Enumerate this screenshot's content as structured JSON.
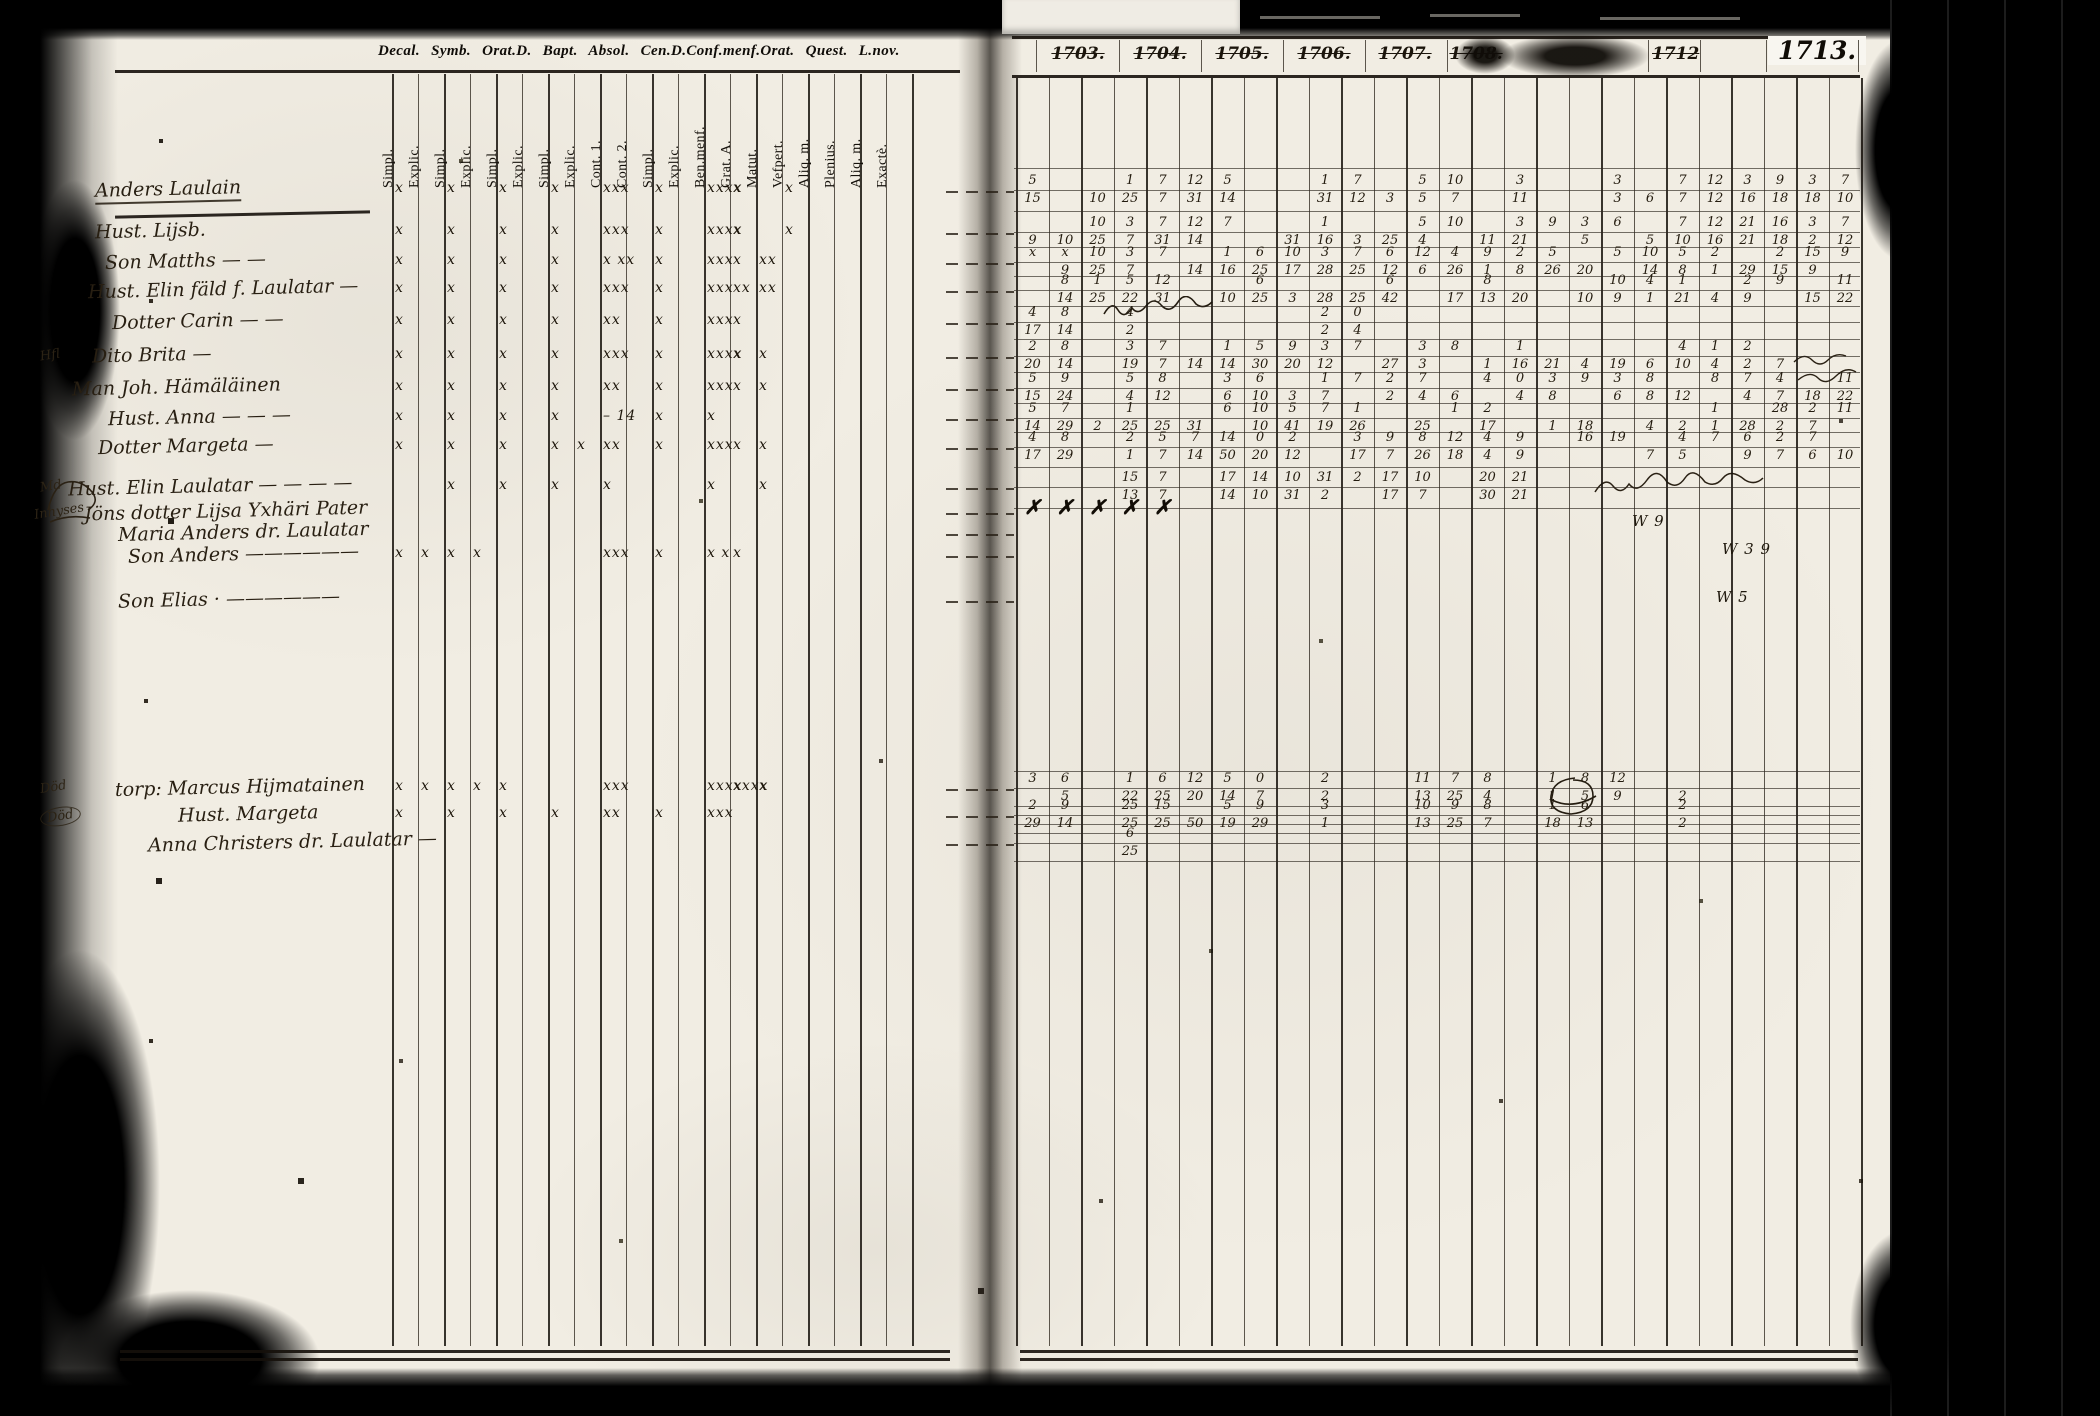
{
  "printed_header": "Decal. Symb. Orat.D. Bapt. Absol. Cen.D.Conf.menf.Orat. Quest. L.nov.",
  "left_page": {
    "column_labels": [
      "Simpl.",
      "Explic.",
      "Simpl.",
      "Explic.",
      "Simpl.",
      "Explic.",
      "Simpl.",
      "Explic.",
      "Cont. 1.",
      "Cont. 2.",
      "Simpl.",
      "Explic.",
      "Ben.menf.",
      "Grat. A.",
      "Matut.",
      "Vefpert.",
      "Aliq. m.",
      "Plenius.",
      "Aliq. m.",
      "Exactè."
    ],
    "rows": [
      {
        "margin": "",
        "name": "Anders Laulain",
        "marks": [
          "x",
          "",
          "x",
          "",
          "x",
          "",
          "x",
          "",
          "xxx",
          "",
          "x",
          "",
          "xxxx",
          "x",
          "",
          "x",
          "",
          "",
          "",
          ""
        ]
      },
      {
        "margin": "",
        "name": "Hust. Lijsb.",
        "marks": [
          "x",
          "",
          "x",
          "",
          "x",
          "",
          "x",
          "",
          "xxx",
          "",
          "x",
          "",
          "xxxx",
          "x",
          "",
          "x",
          "",
          "",
          "",
          ""
        ]
      },
      {
        "margin": "",
        "name": "Son Matths — —",
        "marks": [
          "x",
          "",
          "x",
          "",
          "x",
          "",
          "x",
          "",
          "x xx",
          "",
          "x",
          "",
          "xxx",
          "x",
          "xx",
          "",
          "",
          "",
          "",
          ""
        ]
      },
      {
        "margin": "",
        "name": "Hust. Elin fäld f. Laulatar —",
        "marks": [
          "x",
          "",
          "x",
          "",
          "x",
          "",
          "x",
          "",
          "xxx",
          "",
          "x",
          "",
          "xxx",
          "xx",
          "xx",
          "",
          "",
          "",
          "",
          ""
        ]
      },
      {
        "margin": "",
        "name": "Dotter Carin — —",
        "marks": [
          "x",
          "",
          "x",
          "",
          "x",
          "",
          "x",
          "",
          "xx",
          "",
          "x",
          "",
          "xxx",
          "x",
          "",
          "",
          "",
          "",
          "",
          ""
        ]
      },
      {
        "margin": "Hfl",
        "name": "Dito Brita —",
        "marks": [
          "x",
          "",
          "x",
          "",
          "x",
          "",
          "x",
          "",
          "xxx",
          "",
          "x",
          "",
          "xxxx",
          "x",
          "x",
          "",
          "",
          "",
          "",
          ""
        ]
      },
      {
        "margin": "",
        "name": "Man Joh. Hämäläinen",
        "marks": [
          "x",
          "",
          "x",
          "",
          "x",
          "",
          "x",
          "",
          "xx",
          "",
          "x",
          "",
          "xxx",
          "x",
          "x",
          "",
          "",
          "",
          "",
          ""
        ]
      },
      {
        "margin": "",
        "name": "Hust. Anna — — —",
        "marks": [
          "x",
          "",
          "x",
          "",
          "x",
          "",
          "x",
          "",
          "– 14",
          "",
          "x",
          "",
          "x",
          "",
          "",
          "",
          "",
          "",
          "",
          ""
        ]
      },
      {
        "margin": "",
        "name": "Dotter Margeta —",
        "marks": [
          "x",
          "",
          "x",
          "",
          "x",
          "",
          "x",
          "x",
          "xx",
          "",
          "x",
          "",
          "xxx",
          "x",
          "x",
          "",
          "",
          "",
          "",
          ""
        ]
      },
      {
        "margin": "Md",
        "name": "Hust. Elin Laulatar — — — —",
        "marks": [
          "",
          "",
          "x",
          "",
          "x",
          "",
          "x",
          "",
          "x",
          "",
          "",
          "",
          "x",
          "",
          "x",
          "",
          "",
          "",
          "",
          ""
        ]
      },
      {
        "margin": "Inhyses",
        "name": "Jöns dotter Lijsa Yxhäri Pater",
        "marks": [
          "",
          "",
          "",
          "",
          "",
          "",
          "",
          "",
          "",
          "",
          "",
          "",
          "",
          "",
          "",
          "",
          "",
          "",
          "",
          ""
        ]
      },
      {
        "margin": "",
        "name": "Maria Anders dr. Laulatar",
        "marks": [
          "",
          "",
          "",
          "",
          "",
          "",
          "",
          "",
          "",
          "",
          "",
          "",
          "",
          "",
          "",
          "",
          "",
          "",
          "",
          ""
        ]
      },
      {
        "margin": "",
        "name": "Son Anders ——————",
        "marks": [
          "x",
          "x",
          "x",
          "x",
          "",
          "",
          "",
          "",
          "xxx",
          "",
          "x",
          "",
          "x x",
          "x",
          "",
          "",
          "",
          "",
          "",
          ""
        ]
      },
      {
        "margin": "",
        "name": "Son Elias · ——————",
        "marks": [
          "",
          "",
          "",
          "",
          "",
          "",
          "",
          "",
          "",
          "",
          "",
          "",
          "",
          "",
          "",
          "",
          "",
          "",
          "",
          ""
        ]
      },
      {
        "margin": "Död",
        "name": "torp: Marcus Hijmatainen",
        "marks": [
          "x",
          "x",
          "x",
          "x",
          "x",
          "",
          "",
          "",
          "xxx",
          "",
          "",
          "",
          "xxxx",
          "xxxx",
          "x",
          "",
          "",
          "",
          "",
          ""
        ]
      },
      {
        "margin": "Död",
        "name": "Hust. Margeta",
        "marks": [
          "x",
          "",
          "x",
          "",
          "x",
          "",
          "x",
          "",
          "xx",
          "",
          "x",
          "",
          "xxx",
          "",
          "",
          "",
          "",
          "",
          "",
          ""
        ]
      },
      {
        "margin": "",
        "name": "Anna Christers dr. Laulatar —",
        "marks": [
          "",
          "",
          "",
          "",
          "",
          "",
          "",
          "",
          "",
          "",
          "",
          "",
          "",
          "",
          "",
          "",
          "",
          "",
          "",
          ""
        ]
      }
    ]
  },
  "right_page": {
    "years": [
      {
        "label": "1703.",
        "struck": true
      },
      {
        "label": "1704.",
        "struck": true
      },
      {
        "label": "1705.",
        "struck": true
      },
      {
        "label": "1706.",
        "struck": true
      },
      {
        "label": "1707.",
        "struck": true
      },
      {
        "label": "1708.",
        "struck": true
      },
      {
        "label": "1712",
        "struck": true
      },
      {
        "label": "1713.",
        "struck": false
      }
    ],
    "rows": [
      {
        "l1": [
          "5",
          "",
          "",
          "1",
          "7",
          "12",
          "5",
          "",
          "",
          "1",
          "7",
          "",
          "5",
          "10",
          "",
          "3",
          "",
          "",
          "3",
          "",
          "7",
          "12",
          "3",
          "9",
          "3",
          "7"
        ],
        "l2": [
          "15",
          "",
          "10",
          "25",
          "7",
          "31",
          "14",
          "",
          "",
          "31",
          "12",
          "3",
          "5",
          "7",
          "",
          "11",
          "",
          "",
          "3",
          "6",
          "7",
          "12",
          "16",
          "18",
          "18",
          "10"
        ]
      },
      {
        "l1": [
          "",
          "",
          "10",
          "3",
          "7",
          "12",
          "7",
          "",
          "",
          "1",
          "",
          "",
          "5",
          "10",
          "",
          "3",
          "9",
          "3",
          "6",
          "",
          "7",
          "12",
          "21",
          "16",
          "3",
          "7"
        ],
        "l2": [
          "9",
          "10",
          "25",
          "7",
          "31",
          "14",
          "",
          "",
          "31",
          "16",
          "3",
          "25",
          "4",
          "",
          "11",
          "21",
          "",
          "5",
          "",
          "5",
          "10",
          "16",
          "21",
          "18",
          "2",
          "12"
        ]
      },
      {
        "l1": [
          "x",
          "x",
          "10",
          "3",
          "7",
          "",
          "1",
          "6",
          "10",
          "3",
          "7",
          "6",
          "12",
          "4",
          "9",
          "2",
          "5",
          "",
          "5",
          "10",
          "5",
          "2",
          "",
          "2",
          "15",
          "9"
        ],
        "l2": [
          "",
          "9",
          "25",
          "7",
          "",
          "14",
          "16",
          "25",
          "17",
          "28",
          "25",
          "12",
          "6",
          "26",
          "1",
          "8",
          "26",
          "20",
          "",
          "14",
          "8",
          "1",
          "29",
          "15",
          "9",
          ""
        ]
      },
      {
        "l1": [
          "",
          "8",
          "1",
          "5",
          "12",
          "",
          "",
          "6",
          "",
          "",
          "",
          "6",
          "",
          "",
          "8",
          "",
          "",
          "",
          "10",
          "4",
          "1",
          "",
          "2",
          "9",
          "",
          "11"
        ],
        "l2": [
          "",
          "14",
          "25",
          "22",
          "31",
          "",
          "10",
          "25",
          "3",
          "28",
          "25",
          "42",
          "",
          "17",
          "13",
          "20",
          "",
          "10",
          "9",
          "1",
          "21",
          "4",
          "9",
          "",
          "15",
          "22"
        ]
      },
      {
        "l1": [
          "4",
          "8",
          "",
          "4",
          "",
          "",
          "",
          "",
          "",
          "2",
          "0",
          "",
          "",
          "",
          "",
          "",
          "",
          "",
          "",
          "",
          "",
          "",
          "",
          "",
          "",
          ""
        ],
        "l2": [
          "17",
          "14",
          "",
          "2",
          "",
          "",
          "",
          "",
          "",
          "2",
          "4",
          "",
          "",
          "",
          "",
          "",
          "",
          "",
          "",
          "",
          "",
          "",
          "",
          "",
          "",
          ""
        ]
      },
      {
        "l1": [
          "2",
          "8",
          "",
          "3",
          "7",
          "",
          "1",
          "5",
          "9",
          "3",
          "7",
          "",
          "3",
          "8",
          "",
          "1",
          "",
          "",
          "",
          "",
          "4",
          "1",
          "2",
          "",
          "",
          ""
        ],
        "l2": [
          "20",
          "14",
          "",
          "19",
          "7",
          "14",
          "14",
          "30",
          "20",
          "12",
          "",
          "27",
          "3",
          "",
          "1",
          "16",
          "21",
          "4",
          "19",
          "6",
          "10",
          "4",
          "2",
          "7",
          "",
          ""
        ]
      },
      {
        "l1": [
          "5",
          "9",
          "",
          "5",
          "8",
          "",
          "3",
          "6",
          "",
          "1",
          "7",
          "2",
          "7",
          "",
          "4",
          "0",
          "3",
          "9",
          "3",
          "8",
          "",
          "8",
          "7",
          "4",
          "",
          "11"
        ],
        "l2": [
          "15",
          "24",
          "",
          "4",
          "12",
          "",
          "6",
          "10",
          "3",
          "7",
          "",
          "2",
          "4",
          "6",
          "",
          "4",
          "8",
          "",
          "6",
          "8",
          "12",
          "",
          "4",
          "7",
          "18",
          "22"
        ]
      },
      {
        "l1": [
          "5",
          "7",
          "",
          "1",
          "",
          "",
          "6",
          "10",
          "5",
          "7",
          "1",
          "",
          "",
          "1",
          "2",
          "",
          "",
          "",
          "",
          "",
          "",
          "1",
          "",
          "28",
          "2",
          "11"
        ],
        "l2": [
          "14",
          "29",
          "2",
          "25",
          "25",
          "31",
          "",
          "10",
          "41",
          "19",
          "26",
          "",
          "25",
          "",
          "17",
          "",
          "1",
          "18",
          "",
          "4",
          "2",
          "1",
          "28",
          "2",
          "7",
          ""
        ]
      },
      {
        "l1": [
          "4",
          "8",
          "",
          "2",
          "5",
          "7",
          "14",
          "0",
          "2",
          "",
          "3",
          "9",
          "8",
          "12",
          "4",
          "9",
          "",
          "16",
          "19",
          "",
          "4",
          "7",
          "6",
          "2",
          "7",
          ""
        ],
        "l2": [
          "17",
          "29",
          "",
          "1",
          "7",
          "14",
          "50",
          "20",
          "12",
          "",
          "17",
          "7",
          "26",
          "18",
          "4",
          "9",
          "",
          "",
          "",
          "7",
          "5",
          "",
          "9",
          "7",
          "6",
          "10"
        ]
      },
      {
        "l1": [
          "",
          "",
          "",
          "15",
          "7",
          "",
          "17",
          "14",
          "10",
          "31",
          "2",
          "17",
          "10",
          "",
          "20",
          "21",
          "",
          "",
          "",
          "",
          "",
          "",
          "",
          "",
          "",
          ""
        ],
        "l2": [
          "",
          "",
          "",
          "13",
          "7",
          "",
          "14",
          "10",
          "31",
          "2",
          "",
          "17",
          "7",
          "",
          "30",
          "21",
          "",
          "",
          "",
          "",
          "",
          "",
          "",
          "",
          "",
          ""
        ]
      },
      {
        "l1": [
          "✗",
          "✗",
          "✗",
          "✗",
          "✗",
          "",
          "",
          "",
          "",
          "",
          "",
          "",
          "",
          "",
          "",
          "",
          "",
          "",
          "",
          "",
          "",
          "",
          "",
          "",
          "",
          ""
        ],
        "l2": []
      },
      {
        "l1": [],
        "l2": []
      },
      {
        "l1": [],
        "l2": []
      },
      {
        "l1": [],
        "l2": []
      },
      {
        "l1": [
          "3",
          "6",
          "",
          "1",
          "6",
          "12",
          "5",
          "0",
          "",
          "2",
          "",
          "",
          "11",
          "7",
          "8",
          "",
          "1",
          "8",
          "12",
          "",
          "",
          "",
          "",
          "",
          "",
          ""
        ],
        "l2": [
          "",
          "5",
          "",
          "22",
          "25",
          "20",
          "14",
          "7",
          "",
          "2",
          "",
          "",
          "13",
          "25",
          "4",
          "",
          "1",
          "5",
          "9",
          "",
          "2",
          "",
          "",
          "",
          "",
          ""
        ]
      },
      {
        "l1": [
          "2",
          "9",
          "",
          "25",
          "15",
          "",
          "5",
          "9",
          "",
          "3",
          "",
          "",
          "10",
          "9",
          "8",
          "",
          "1",
          "6",
          "",
          "",
          "2",
          "",
          "",
          "",
          "",
          ""
        ],
        "l2": [
          "29",
          "14",
          "",
          "25",
          "25",
          "50",
          "19",
          "29",
          "",
          "1",
          "",
          "",
          "13",
          "25",
          "7",
          "",
          "18",
          "13",
          "",
          "",
          "2",
          "",
          "",
          "",
          "",
          ""
        ]
      },
      {
        "l1": [
          "",
          "",
          "",
          "6",
          "",
          "",
          "",
          "",
          "",
          "",
          "",
          "",
          "",
          "",
          "",
          "",
          "",
          "",
          "",
          "",
          "",
          "",
          "",
          "",
          "",
          ""
        ],
        "l2": [
          "",
          "",
          "",
          "25",
          "",
          "",
          "",
          "",
          "",
          "",
          "",
          "",
          "",
          "",
          "",
          "",
          "",
          "",
          "",
          "",
          "",
          "",
          "",
          "",
          "",
          ""
        ]
      }
    ],
    "margin_annotations": [
      "W 9",
      "W 3 9",
      "W 5"
    ]
  }
}
